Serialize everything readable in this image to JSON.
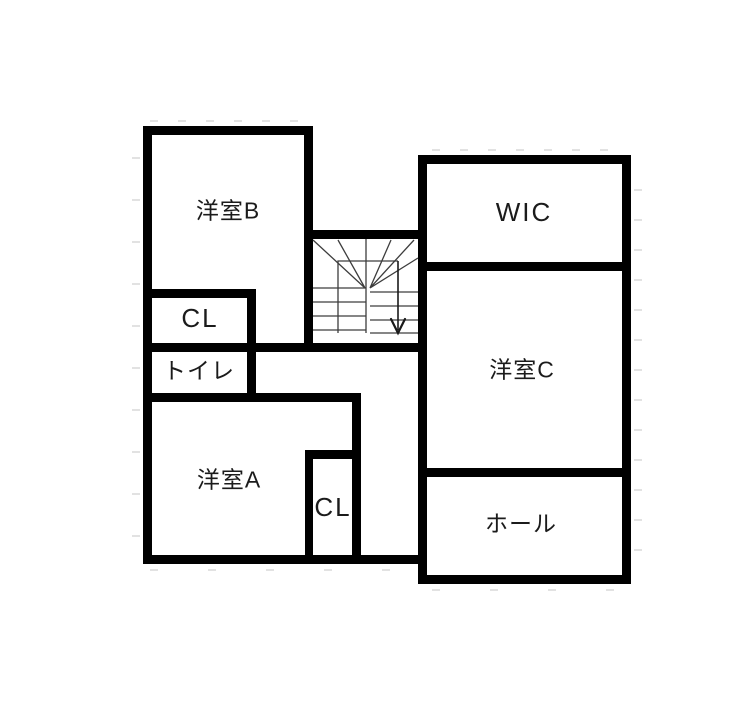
{
  "plan": {
    "type": "floor-plan",
    "rooms": [
      {
        "id": "room-b",
        "label": "洋室B"
      },
      {
        "id": "wic",
        "label": "WIC"
      },
      {
        "id": "closet-upper",
        "label": "CL"
      },
      {
        "id": "toilet",
        "label": "トイレ"
      },
      {
        "id": "room-a",
        "label": "洋室A"
      },
      {
        "id": "closet-lower",
        "label": "CL"
      },
      {
        "id": "room-c",
        "label": "洋室C"
      },
      {
        "id": "hall",
        "label": "ホール"
      }
    ],
    "stairs": {
      "direction_icon": "down-arrow-icon",
      "style": "u-turn-with-winders"
    },
    "colors": {
      "wall": "#000000",
      "background": "#ffffff",
      "stair_lines": "#3d3d3d",
      "grid_ticks": "#d9d9d9",
      "text": "#1b1b1b"
    }
  }
}
